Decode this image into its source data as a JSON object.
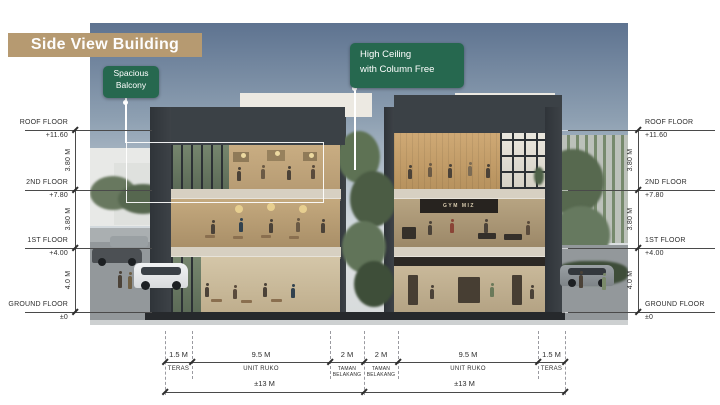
{
  "slide": {
    "title": "Side View Building"
  },
  "callouts": {
    "balcony": {
      "line1": "Spacious",
      "line2": "Balcony"
    },
    "ceiling": {
      "line1": "High Ceiling",
      "line2": "with Column Free"
    }
  },
  "levels": [
    {
      "name": "ROOF FLOOR",
      "elevation": "+11.60"
    },
    {
      "name": "2ND FLOOR",
      "elevation": "+7.80"
    },
    {
      "name": "1ST FLOOR",
      "elevation": "+4.00"
    },
    {
      "name": "GROUND FLOOR",
      "elevation": "±0"
    }
  ],
  "vertical_dims": [
    "3.80 M",
    "3.80 M",
    "4.0 M"
  ],
  "bottom_dims": {
    "segments": [
      {
        "value": "1.5 M",
        "label": "TERAS"
      },
      {
        "value": "9.5 M",
        "label": "UNIT RUKO"
      },
      {
        "value": "2 M",
        "label": "TAMAN",
        "label2": "BELAKANG"
      },
      {
        "value": "2 M",
        "label": "TAMAN",
        "label2": "BELAKANG"
      },
      {
        "value": "9.5 M",
        "label": "UNIT RUKO"
      },
      {
        "value": "1.5 M",
        "label": "TERAS"
      }
    ],
    "totals": [
      "±13 M",
      "±13 M"
    ]
  },
  "building": {
    "gym_sign": "GYM MIZ"
  },
  "colors": {
    "banner": "#b69a71",
    "badge_green": "#26684f",
    "charcoal": "#3b4146",
    "sky_top": "#5e7390"
  }
}
